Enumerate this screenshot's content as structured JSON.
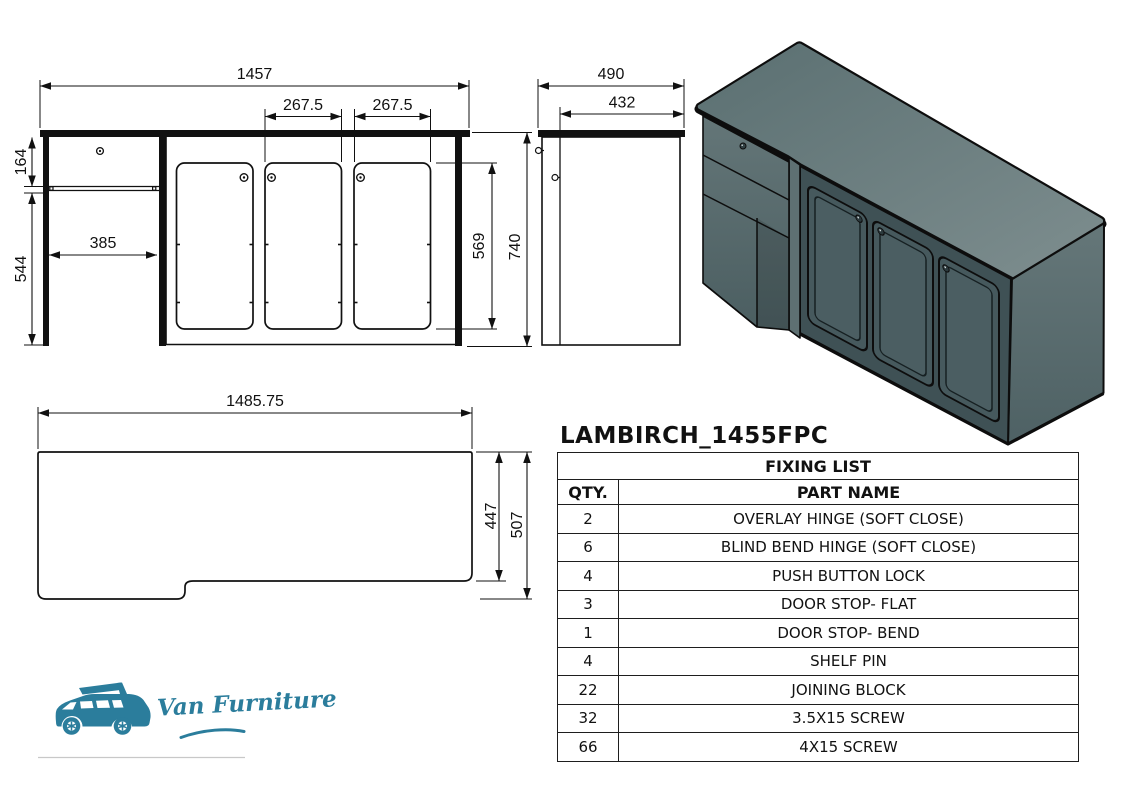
{
  "drawing_title": "LAMBIRCH_1455FPC",
  "views": {
    "front": {
      "dims": {
        "total_width": "1457",
        "door2_width": "267.5",
        "door3_width": "267.5",
        "drawer_height": "164",
        "knee_width": "385",
        "under_height": "544",
        "door_height": "569",
        "total_height": "740"
      }
    },
    "side": {
      "dims": {
        "total_depth": "490",
        "body_depth": "432"
      }
    },
    "plan": {
      "dims": {
        "panel_width": "1485.75",
        "right_depth": "447",
        "total_depth": "507"
      }
    }
  },
  "fixing_list": {
    "title": "FIXING LIST",
    "columns": {
      "qty": "QTY.",
      "part": "PART NAME"
    },
    "rows": [
      {
        "qty": "2",
        "part": "OVERLAY HINGE (SOFT CLOSE)"
      },
      {
        "qty": "6",
        "part": "BLIND BEND HINGE (SOFT CLOSE)"
      },
      {
        "qty": "4",
        "part": "PUSH BUTTON LOCK"
      },
      {
        "qty": "3",
        "part": "DOOR STOP- FLAT"
      },
      {
        "qty": "1",
        "part": "DOOR STOP- BEND"
      },
      {
        "qty": "4",
        "part": "SHELF PIN"
      },
      {
        "qty": "22",
        "part": "JOINING BLOCK"
      },
      {
        "qty": "32",
        "part": "3.5X15 SCREW"
      },
      {
        "qty": "66",
        "part": "4X15 SCREW"
      }
    ]
  },
  "logo": {
    "brand": "Van Furniture",
    "color": "#2b7d9c"
  },
  "colors": {
    "line": "#111111",
    "iso_top": "#66797b",
    "iso_front": "#3f5155",
    "iso_side": "#5a6d6f",
    "accent": "#2b7d9c"
  }
}
